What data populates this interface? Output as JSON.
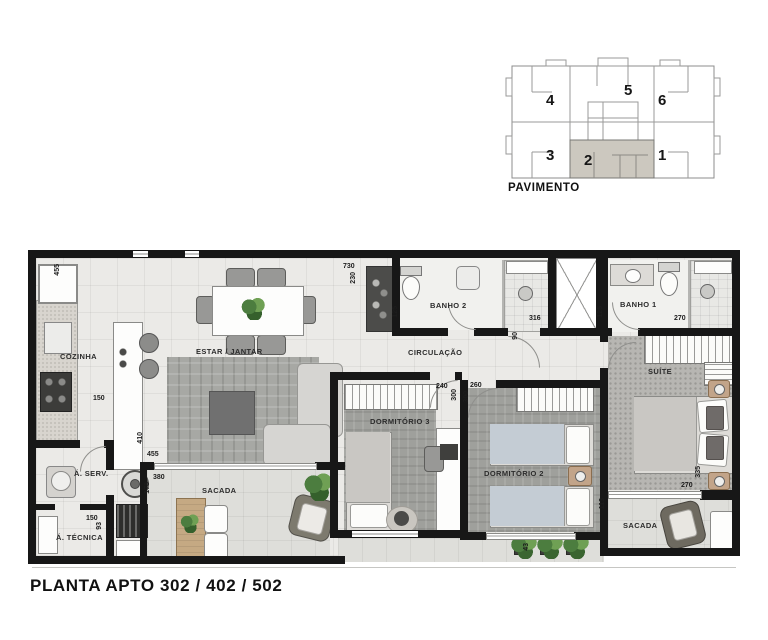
{
  "title": "PLANTA APTO  302 / 402 / 502",
  "keyplan": {
    "label": "PAVIMENTO",
    "units": [
      "4",
      "5",
      "6",
      "3",
      "2",
      "1"
    ],
    "highlighted_unit": "2",
    "highlight_color": "#ccc8bf"
  },
  "rooms": {
    "cozinha": "COZINHA",
    "estar_jantar": "ESTAR / JANTAR",
    "circulacao": "CIRCULAÇÃO",
    "banho2": "BANHO 2",
    "banho1": "BANHO 1",
    "suite": "SUÍTE",
    "dormitorio3": "DORMITÓRIO 3",
    "dormitorio2": "DORMITÓRIO 2",
    "sacada_estar": "SACADA",
    "sacada_suite": "SACADA",
    "area_servico": "Á. SERV.",
    "area_tecnica": "Á. TÉCNICA"
  },
  "dims": {
    "cozinha_455": "455",
    "cozinha_150": "150",
    "estar_410": "410",
    "estar_455": "455",
    "sacada_380": "380",
    "sacada_178": "178",
    "atecnica_150": "150",
    "atecnica_93": "93",
    "topo_730": "730",
    "topo_230": "230",
    "banho2_125": "125",
    "banho2_316": "316",
    "circ_90": "90",
    "banho1_125": "125",
    "banho1_270": "270",
    "dorm3_240": "240",
    "dorm3_300": "300",
    "dorm2_260": "260",
    "dorm2_300": "300",
    "suite_335": "335",
    "suite_270": "270",
    "sacada_suite_113": "113",
    "jardineira_43": "43"
  },
  "colors": {
    "wall": "#171717",
    "floor": "#ebeae7",
    "keyplan_highlight": "#ccc8bf",
    "plant": "#4c7d3f"
  }
}
